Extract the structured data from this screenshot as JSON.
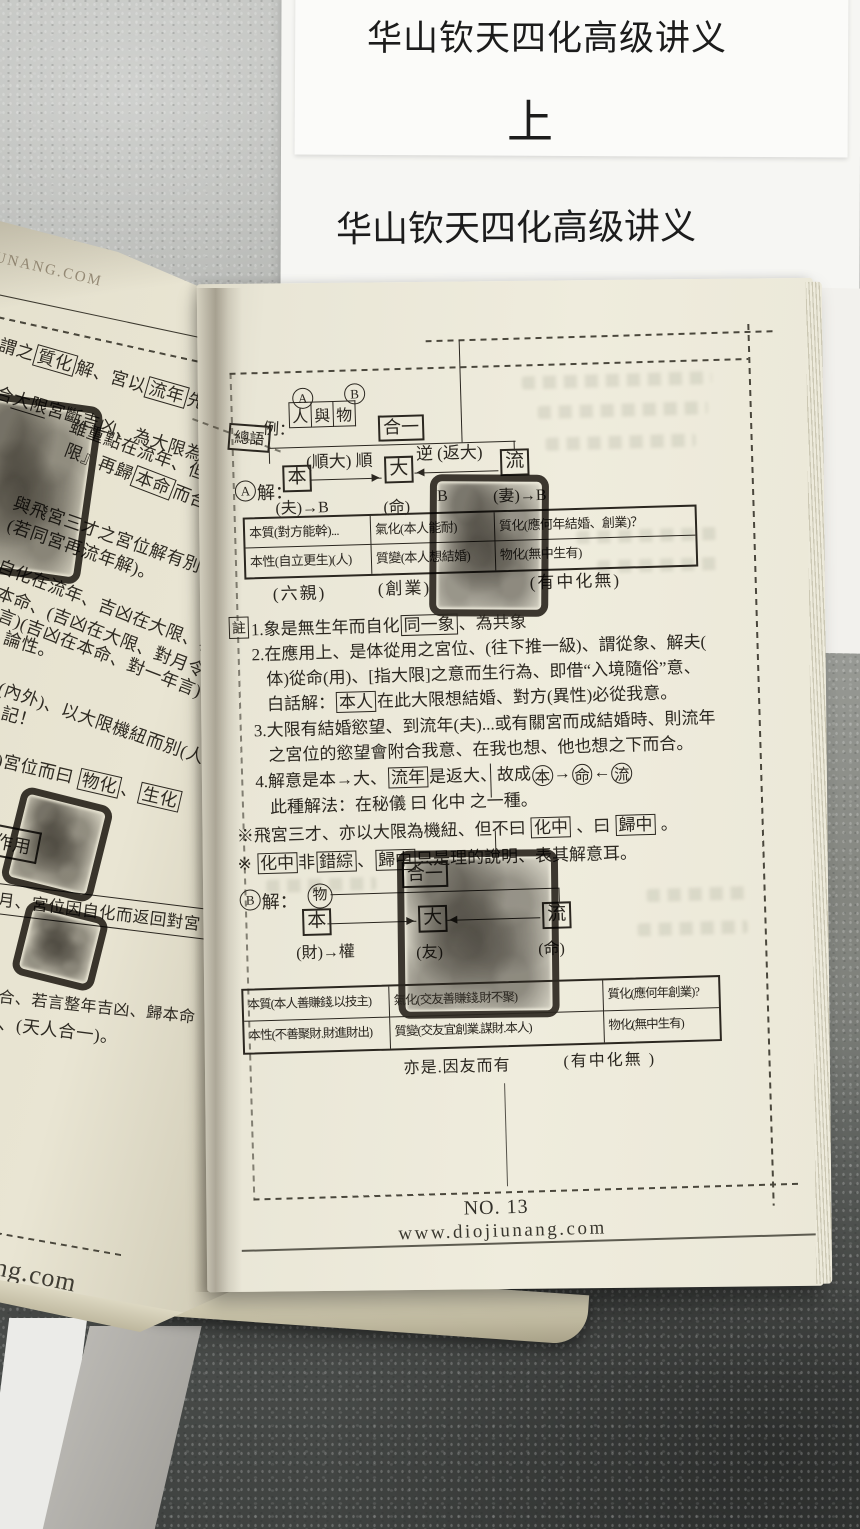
{
  "covers": {
    "title_top": "华山钦天四化高级讲义",
    "volume": "上",
    "title_bottom": "华山钦天四化高级讲义"
  },
  "left_page": {
    "watermark_top": "IUNANG.COM",
    "watermark_bottom": "ng.com",
    "stamp_box_label": "作用",
    "lines": {
      "l1": [
        {
          "k": "t",
          "s": "謂之"
        },
        {
          "k": "box",
          "s": "質化"
        },
        {
          "k": "t",
          "s": "解、宮以"
        },
        {
          "k": "box",
          "s": "流年"
        },
        {
          "k": "t",
          "s": "先解"
        }
      ],
      "l2": [
        {
          "k": "t",
          "s": "合"
        },
        {
          "k": "ul",
          "s": "大限"
        },
        {
          "k": "t",
          "s": "宮斷吉凶、為大限為提"
        }
      ],
      "l3": [
        {
          "k": "t",
          "s": "雖重點在流年、但吉凶"
        }
      ],
      "l4": [
        {
          "k": "t",
          "s": "限』再歸"
        },
        {
          "k": "box",
          "s": "本命"
        },
        {
          "k": "t",
          "s": "而合"
        }
      ],
      "l5": [
        {
          "k": "t",
          "s": "與飛宮三才之宮位解有別"
        }
      ],
      "l6": [
        {
          "k": "t",
          "s": "(若同宮再流年解)。"
        }
      ],
      "l7": [
        {
          "k": "t",
          "s": "自化在流年、吉凶在大限、再"
        }
      ],
      "l8": [
        {
          "k": "t",
          "s": "本命、(吉凶在大限、對月令"
        }
      ],
      "l9": [
        {
          "k": "t",
          "s": "言)(吉凶在本命、對一年言)"
        }
      ],
      "l10": [
        {
          "k": "t",
          "s": "論性。"
        }
      ],
      "l11": [
        {
          "k": "t",
          "s": "(內外)、以大限機紐而別(人"
        }
      ],
      "l12": [
        {
          "k": "t",
          "s": "記！"
        }
      ],
      "l13": [
        {
          "k": "t",
          "s": ")宮位而曰 "
        },
        {
          "k": "box",
          "s": "物化"
        },
        {
          "k": "t",
          "s": "、"
        },
        {
          "k": "box",
          "s": "生化"
        }
      ],
      "l15": [
        {
          "k": "t",
          "s": "月、宮位因自化而返回對宮"
        }
      ],
      "l16": [
        {
          "k": "t",
          "s": "合、若言整年吉凶、歸本命"
        }
      ],
      "l17": [
        {
          "k": "t",
          "s": "、(天人合一)。"
        }
      ]
    }
  },
  "right_page": {
    "header": {
      "marker_boxed": "總語",
      "marker_suffix": "例：",
      "circle_a": "A",
      "circle_b": "B",
      "subjects": [
        "人",
        "與",
        "物"
      ],
      "unity": "合一"
    },
    "diagram_a": {
      "circle": "A",
      "label": "解：",
      "ben": "本",
      "da": "大",
      "liu": "流",
      "left_arrow_label": "(順大) 順",
      "right_arrow_label": "逆 (返大)",
      "sub_ben": "(夫)→B",
      "sub_da": "(命)",
      "sub_da_b": "B",
      "sub_liu": "(妻)→B"
    },
    "table_a": {
      "rows": [
        [
          "本質(對方能幹)...",
          "氣化(本人能耐)",
          "質化(應何年結婚、創業)？"
        ],
        [
          "本性(自立更生)(人)",
          "質變(本人想結婚)",
          "物化(無中生有)"
        ]
      ],
      "captions": [
        "(六親)",
        "(創業)",
        "(有中化無)"
      ]
    },
    "notes": {
      "marker": "註",
      "n1": [
        {
          "k": "t",
          "s": "1.象是無生年而自化"
        },
        {
          "k": "box",
          "s": "同一象"
        },
        {
          "k": "t",
          "s": "、為共象"
        }
      ],
      "n2a": [
        {
          "k": "t",
          "s": "2.在應用上、是体從用之宮位、(往下推一級)、謂從象、解夫("
        }
      ],
      "n2b": [
        {
          "k": "t",
          "s": "体)從命(用)、[指大限]之意而生行為、即借“入境隨俗”意、"
        }
      ],
      "n2c": [
        {
          "k": "t",
          "s": "白話解："
        },
        {
          "k": "box",
          "s": "本人"
        },
        {
          "k": "t",
          "s": "在此大限想結婚、對方(異性)必從我意。"
        }
      ],
      "n3a": [
        {
          "k": "t",
          "s": "3.大限有結婚慾望、到流年(夫)...或有關宮而成結婚時、則流年"
        }
      ],
      "n3b": [
        {
          "k": "t",
          "s": "之宮位的慾望會附合我意、在我也想、他也想之下而合。"
        }
      ],
      "n4a": [
        {
          "k": "t",
          "s": "4.解意是本→大、"
        },
        {
          "k": "box",
          "s": "流年"
        },
        {
          "k": "t",
          "s": "是返大、故成"
        },
        {
          "k": "circle",
          "s": "本"
        },
        {
          "k": "t",
          "s": "→"
        },
        {
          "k": "circle",
          "s": "命"
        },
        {
          "k": "t",
          "s": "←"
        },
        {
          "k": "circle",
          "s": "流"
        }
      ],
      "n4b": [
        {
          "k": "t",
          "s": "此種解法：在秘儀 曰 化中 之一種。"
        }
      ]
    },
    "remarks": {
      "r1": [
        {
          "k": "t",
          "s": "※飛宮三才、亦以大限為機紐、但不曰 "
        },
        {
          "k": "box",
          "s": "化中"
        },
        {
          "k": "t",
          "s": " 、曰 "
        },
        {
          "k": "box",
          "s": "歸中"
        },
        {
          "k": "t",
          "s": " 。"
        }
      ],
      "r2": [
        {
          "k": "t",
          "s": "※ "
        },
        {
          "k": "box",
          "s": "化中"
        },
        {
          "k": "t",
          "s": "非"
        },
        {
          "k": "box",
          "s": "錯綜"
        },
        {
          "k": "t",
          "s": "、"
        },
        {
          "k": "box",
          "s": "歸中"
        },
        {
          "k": "t",
          "s": "只是理的說明、表其解意耳。"
        }
      ]
    },
    "diagram_b": {
      "circle": "B",
      "label": "解：",
      "wu": "物",
      "ben": "本",
      "da": "大",
      "liu": "流",
      "unity": "合一",
      "sub_ben": "(財)→權",
      "sub_da": "(友)",
      "sub_liu": "(命)"
    },
    "table_b": {
      "rows": [
        [
          "本質(本人善賺錢.以技主)",
          "氣化(交友善賺錢.財不聚)",
          "質化(應何年創業)?"
        ],
        [
          "本性(不善聚財.財進財出)",
          "質變(交友宜創業.謀財.本人)",
          "物化(無中生有)"
        ]
      ],
      "captions": [
        "亦是.因友而有",
        "(有中化無 )"
      ]
    },
    "footer": {
      "page_no": "NO. 13",
      "website": "www.diojiunang.com"
    }
  }
}
